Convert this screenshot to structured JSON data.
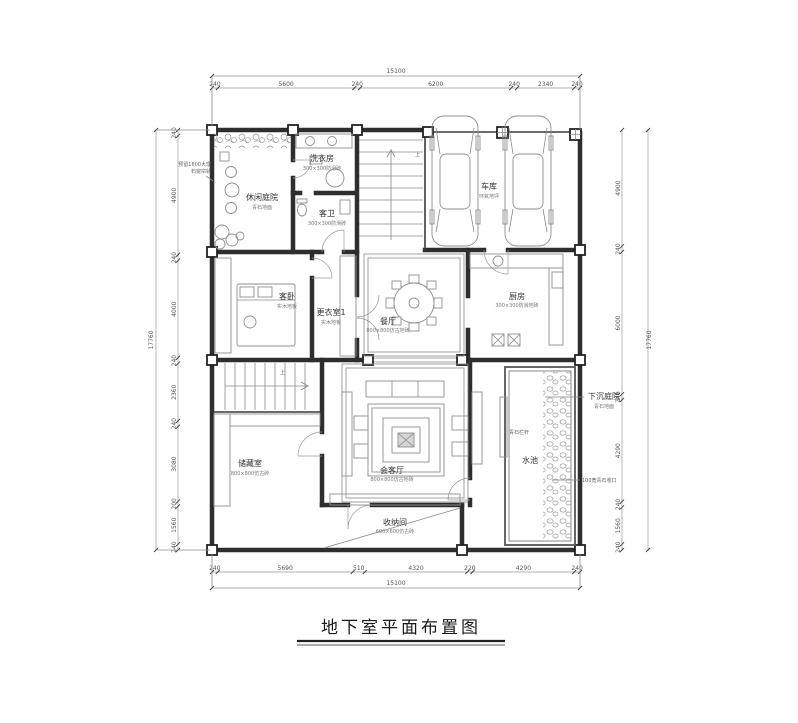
{
  "title": {
    "text": "地下室平面布置图"
  },
  "rooms": [
    {
      "name": "休闲庭院",
      "sub": "青石地面"
    },
    {
      "name": "洗衣房",
      "sub": "300×300防滑砖"
    },
    {
      "name": "客卫",
      "sub": "300×300防滑砖"
    },
    {
      "name": "客卧",
      "sub": "实木地板"
    },
    {
      "name": "更衣室1",
      "sub": "实木地板"
    },
    {
      "name": "餐厅",
      "sub": "800×800仿古地砖"
    },
    {
      "name": "厨房",
      "sub": "300×300防滑地砖"
    },
    {
      "name": "车库",
      "sub": "环氧地坪"
    },
    {
      "name": "储藏室",
      "sub": "800×800仿古砖"
    },
    {
      "name": "会客厅",
      "sub": "800×800仿古地砖"
    },
    {
      "name": "收纳间",
      "sub": "600×600仿古砖"
    },
    {
      "name": "水池",
      "sub": ""
    },
    {
      "name": "下沉庭院",
      "sub": "青石地面"
    }
  ],
  "annotations": {
    "up_label": "上",
    "curtain_note_line1": "预留1800大理",
    "curtain_note_line2": "石窗帘轨",
    "railing_note": "青石栏杆",
    "stone_edge_note": "100宽青石收口"
  },
  "dimensions": {
    "top": {
      "total": "15100",
      "segments": [
        "240",
        "5600",
        "240",
        "6200",
        "240",
        "2340",
        "240"
      ]
    },
    "bottom": {
      "total": "15100",
      "segments": [
        "240",
        "5690",
        "510",
        "4320",
        "220",
        "4290",
        "240"
      ]
    },
    "left": {
      "total": "17760",
      "segments": [
        "240",
        "4900",
        "240",
        "4000",
        "240",
        "2360",
        "240",
        "3080",
        "200",
        "1560",
        "240"
      ]
    },
    "right": {
      "total": "17760",
      "segments": [
        "4900",
        "240",
        "6000",
        "240",
        "4290",
        "240",
        "1560",
        "240"
      ]
    }
  }
}
